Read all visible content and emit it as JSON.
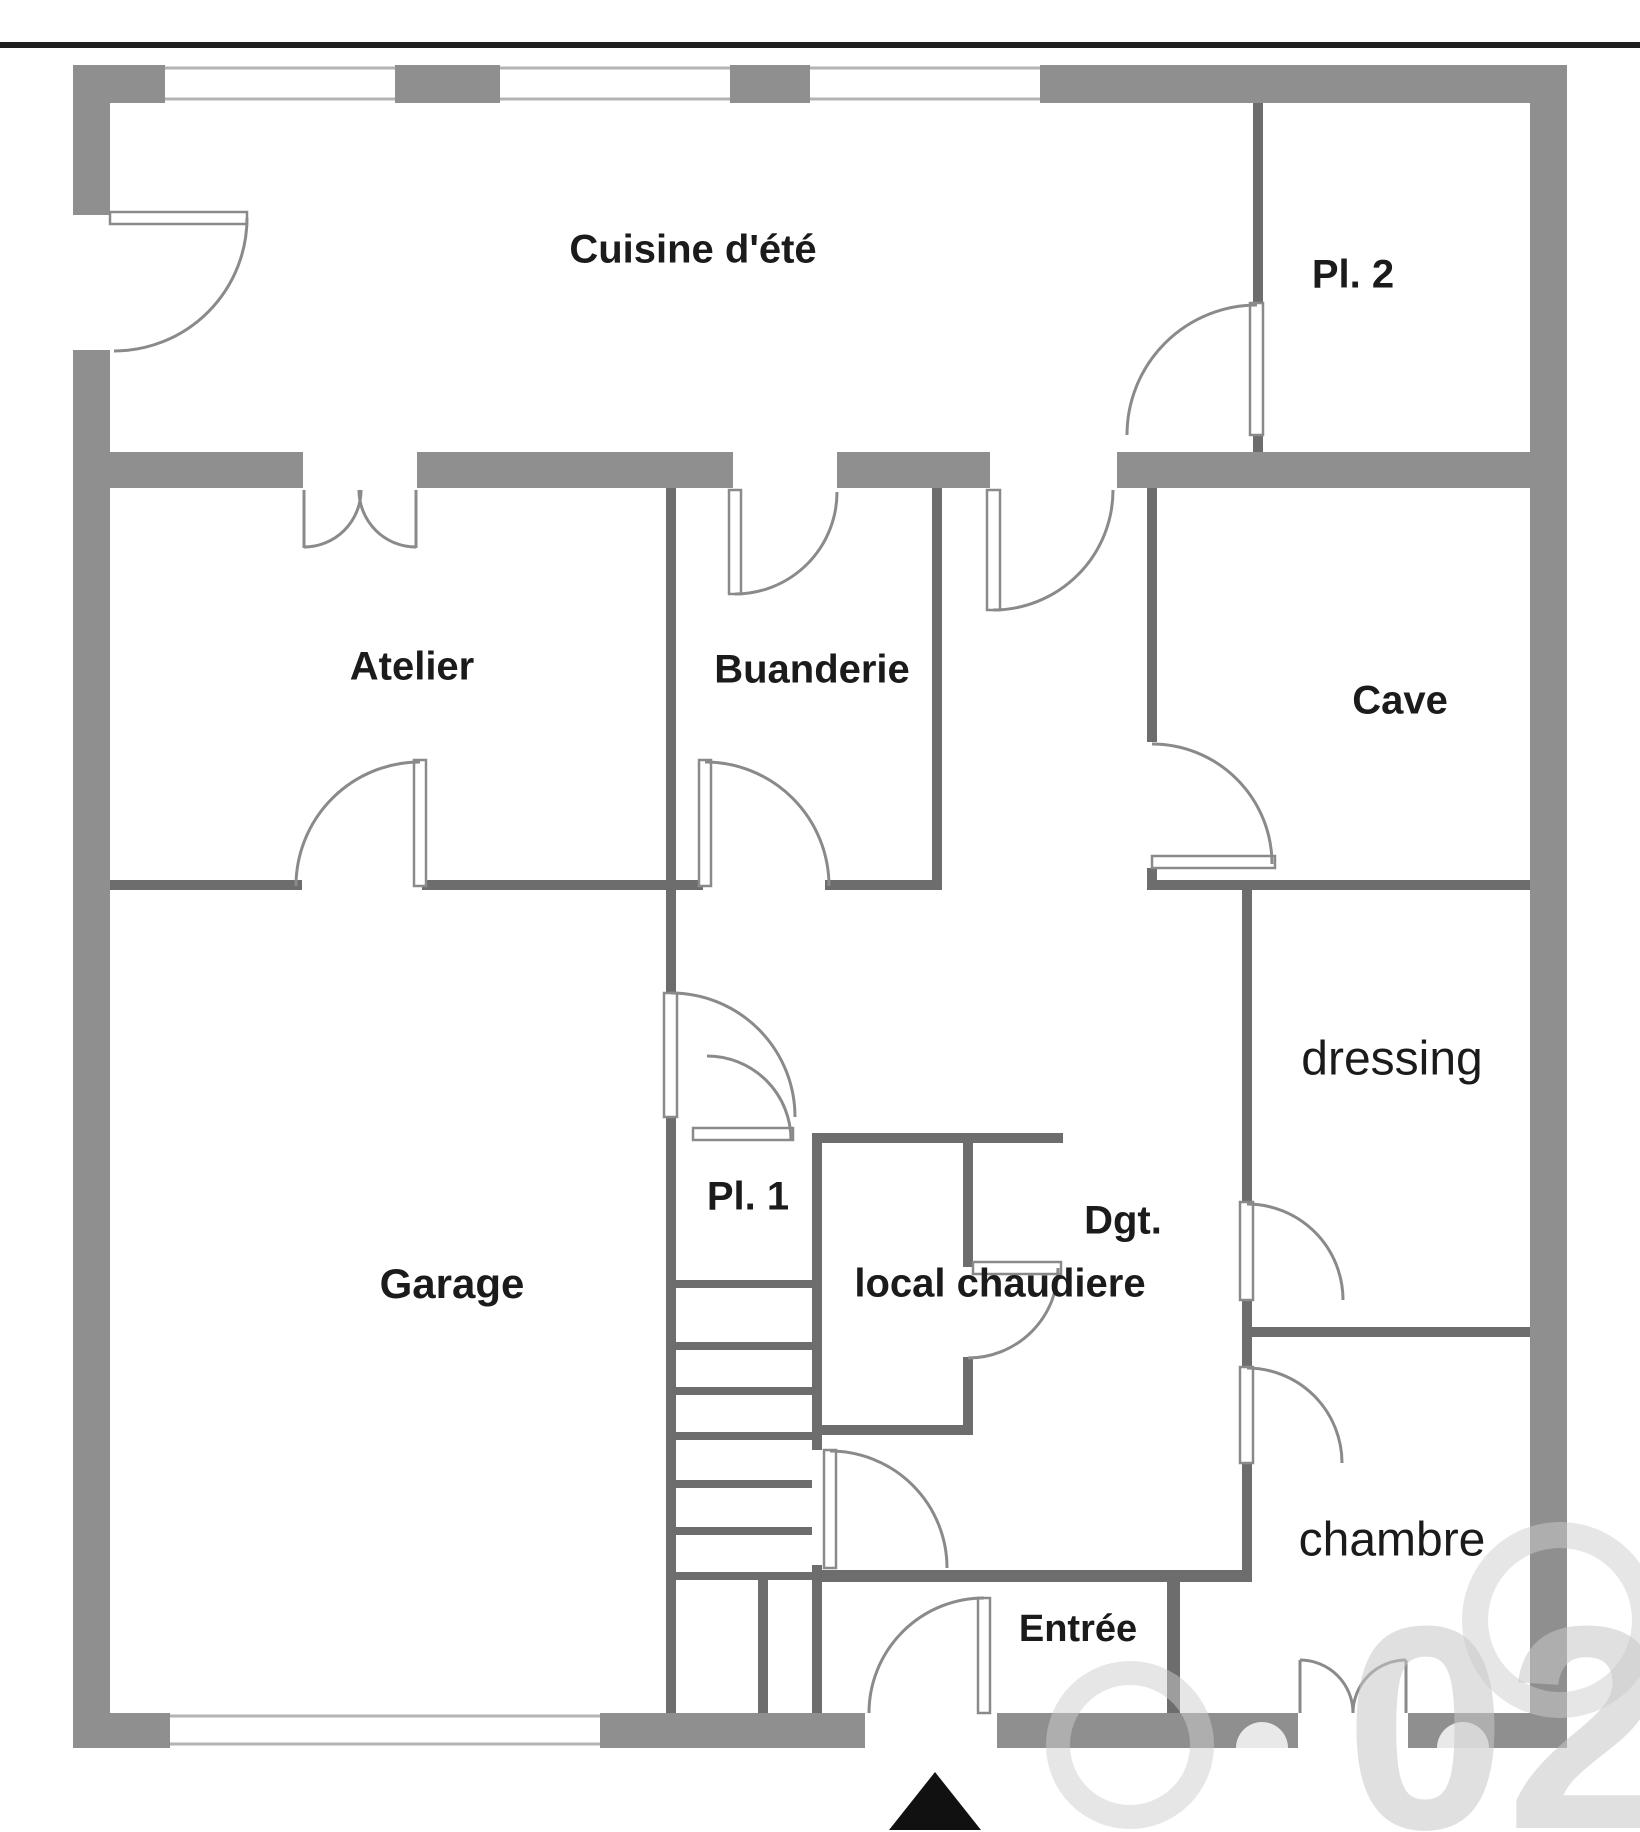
{
  "meta": {
    "type": "floor-plan",
    "language": "French",
    "floor": "basement / garden level"
  },
  "rooms": {
    "cuisine": {
      "label": "Cuisine d'été"
    },
    "pl2": {
      "label": "Pl. 2"
    },
    "atelier": {
      "label": "Atelier"
    },
    "buanderie": {
      "label": "Buanderie"
    },
    "cave": {
      "label": "Cave"
    },
    "garage": {
      "label": "Garage"
    },
    "pl1": {
      "label": "Pl. 1"
    },
    "dgt": {
      "label": "Dgt."
    },
    "chaudiere": {
      "label": "local chaudiere"
    },
    "dressing": {
      "label": "dressing"
    },
    "chambre": {
      "label": "chambre"
    },
    "entree": {
      "label": "Entrée"
    }
  },
  "watermark": {
    "text": "02"
  },
  "colors": {
    "wall_thick": "#8f8f8f",
    "wall_thin": "#6d6d6d",
    "door_stroke": "#8a8a8a",
    "label_text": "#1b1b1b",
    "watermark": "#c8c8c8",
    "north_arrow": "#111111",
    "background": "#ffffff"
  }
}
